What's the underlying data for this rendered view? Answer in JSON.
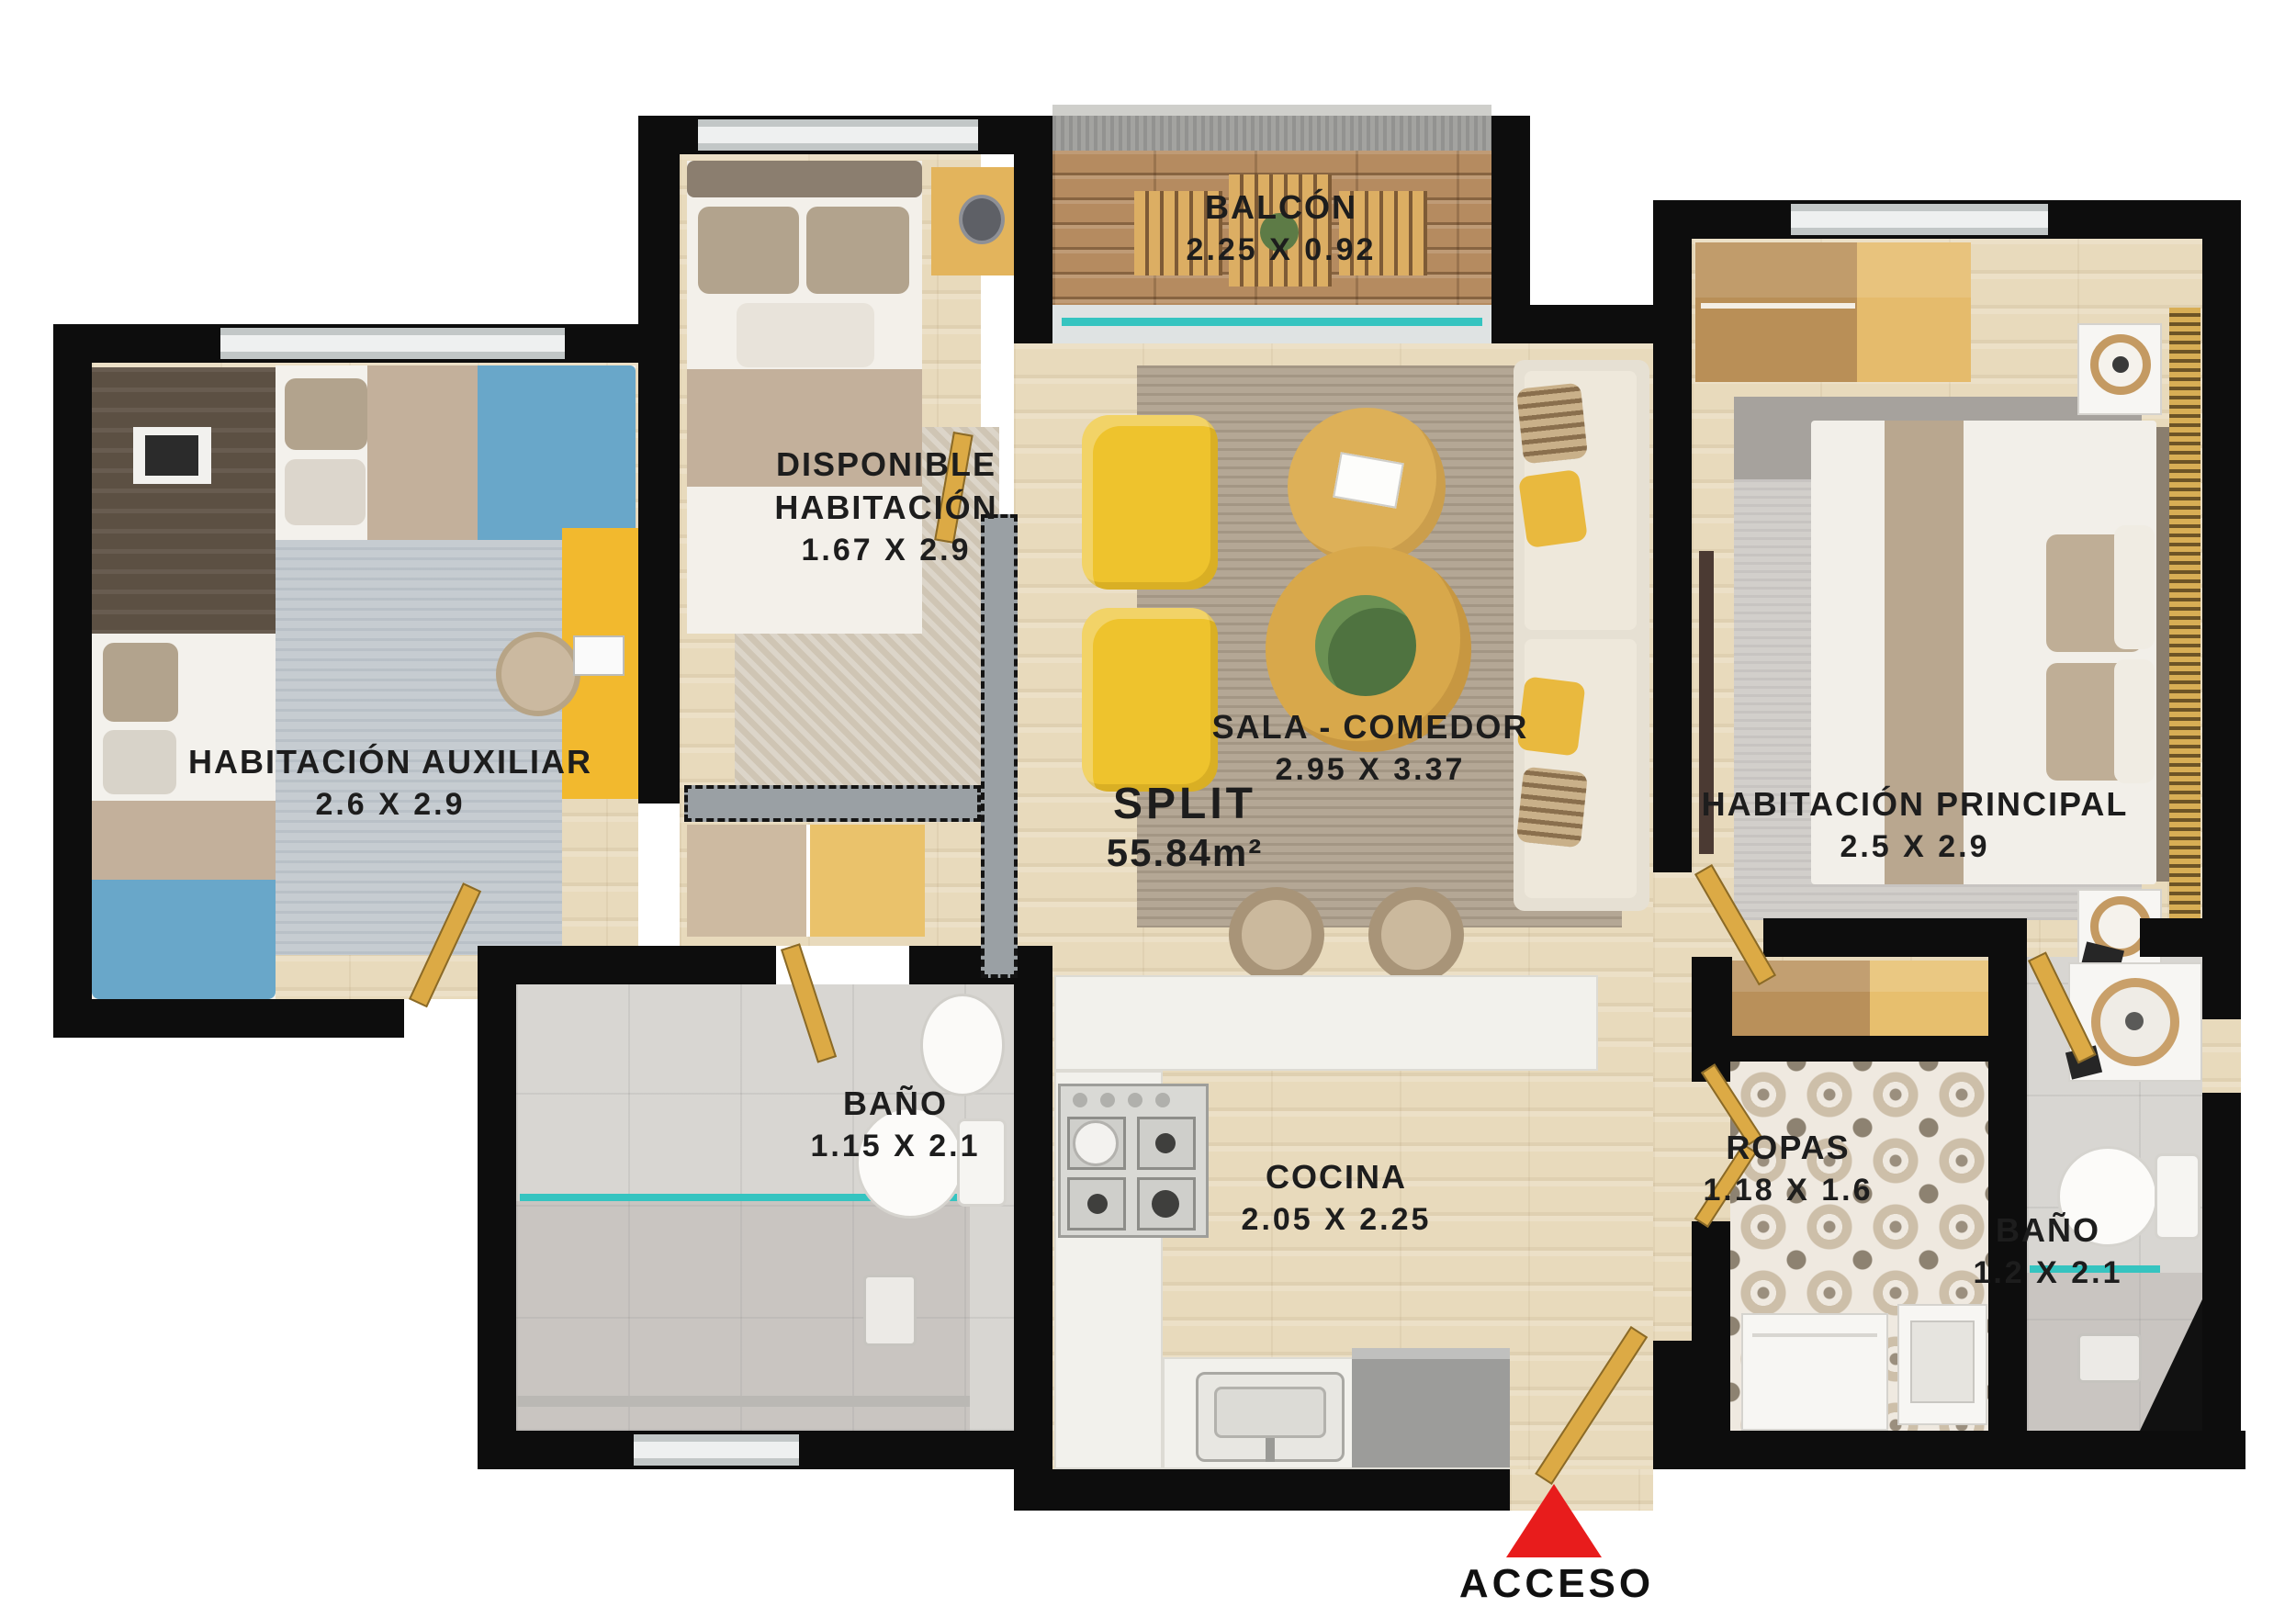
{
  "title": "Planta apartamento SPLIT",
  "unit": {
    "name": "SPLIT",
    "area": "55.84m²"
  },
  "rooms": {
    "balcon": {
      "lines": [
        "BALCÓN",
        "2.25 X 0.92"
      ]
    },
    "disponible": {
      "lines": [
        "DISPONIBLE",
        "HABITACIÓN",
        "1.67 X 2.9"
      ]
    },
    "auxiliar": {
      "lines": [
        "HABITACIÓN AUXILIAR",
        "2.6 X 2.9"
      ]
    },
    "sala": {
      "lines": [
        "SALA - COMEDOR",
        "2.95 X 3.37"
      ]
    },
    "principal": {
      "lines": [
        "HABITACIÓN PRINCIPAL",
        "2.5 X 2.9"
      ]
    },
    "bano_izq": {
      "lines": [
        "BAÑO",
        "1.15 X 2.1"
      ]
    },
    "cocina": {
      "lines": [
        "COCINA",
        "2.05 X 2.25"
      ]
    },
    "ropas": {
      "lines": [
        "ROPAS",
        "1.18 X 1.6"
      ]
    },
    "bano_der": {
      "lines": [
        "BAÑO",
        "1.2 X 2.1"
      ]
    }
  },
  "access": {
    "label": "ACCESO"
  },
  "colors": {
    "wall": "#0d0d0d",
    "wood_floor": "#e8dabc",
    "balcony_deck": "#b58b60",
    "bath_tile": "#d8d6d2",
    "ropas_tile": "#efe9e0",
    "accent_yellow": "#eec32d",
    "accent_blue": "#69a7c9",
    "glass_teal": "#35c4c0",
    "door_gold": "#dcaa45",
    "access_red": "#e81c1c",
    "label_text": "#1d1d1d"
  }
}
